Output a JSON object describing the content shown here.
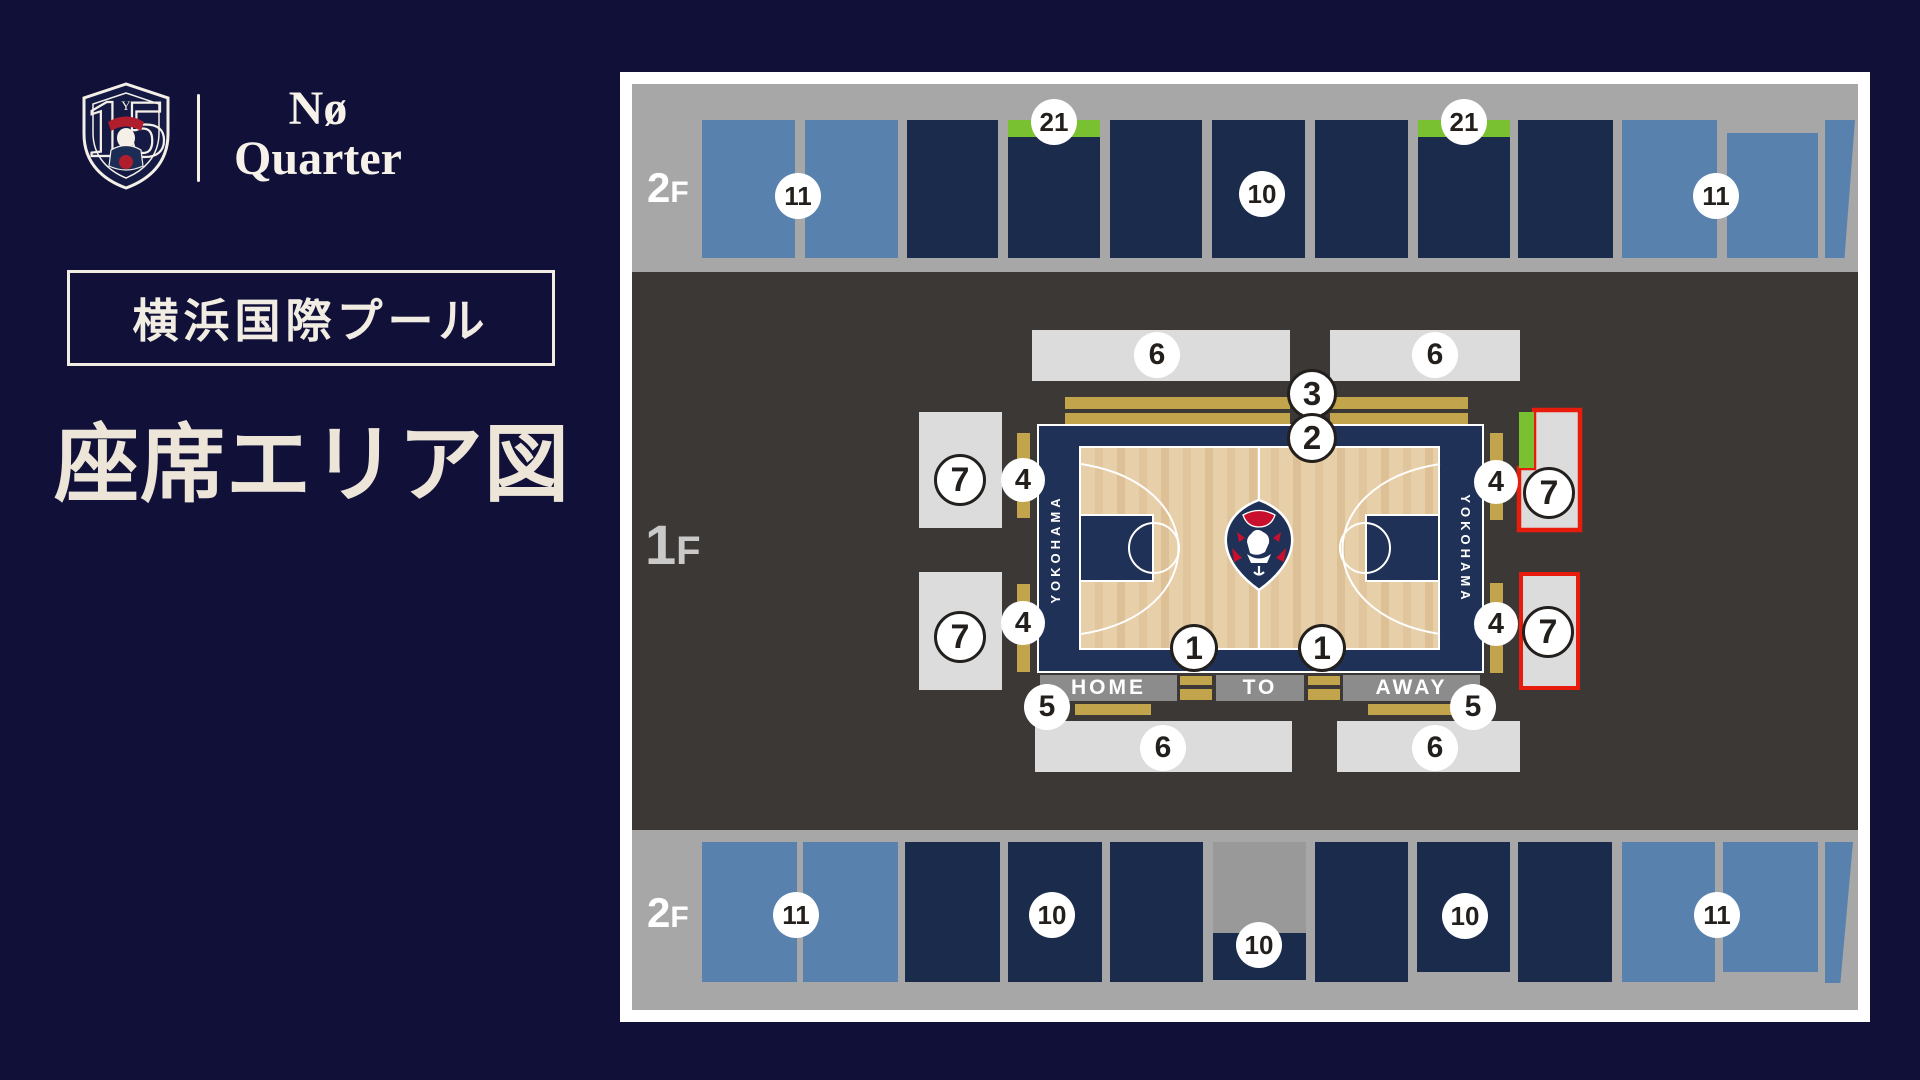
{
  "brand": {
    "anniversary_number": "15",
    "wordmark_top": "Nø",
    "wordmark_bottom": "Quarter",
    "pennant_letter": "Y"
  },
  "venue_label": "横浜国際プール",
  "page_title": "座席エリア図",
  "court": {
    "home_label": "HOME",
    "table_officials_label": "TO",
    "away_label": "AWAY",
    "side_text_left": "YOKOHAMA",
    "side_text_right": "YOKOHAMA"
  },
  "colors": {
    "pageBg": "#101038",
    "cream": "#ece5d8",
    "bandGray": "#a7a7a7",
    "notchGray": "#999999",
    "charcoal": "#3b3835",
    "lightBlue": "#5881ae",
    "navyBlock": "#1a2b4c",
    "lightGray": "#dcdcdc",
    "barGray": "#8c8c8c",
    "gold": "#c2a44c",
    "courtNavy": "#1f3156",
    "wood": "#e7cfa9",
    "red": "#e81c0c",
    "green": "#79c131",
    "badgeText": "#231f1c",
    "white": "#ffffff"
  },
  "map": {
    "floor_labels": [
      {
        "num": "2",
        "suf": "F",
        "x": 27,
        "y": 92,
        "numSize": 42,
        "sufSize": 30,
        "color": "#ffffff"
      },
      {
        "num": "1",
        "suf": "F",
        "x": 25,
        "y": 440,
        "numSize": 56,
        "sufSize": 40,
        "color": "#c9c9c9"
      },
      {
        "num": "2",
        "suf": "F",
        "x": 27,
        "y": 817,
        "numSize": 42,
        "sufSize": 30,
        "color": "#ffffff"
      }
    ],
    "top_blocks": [
      {
        "x": 82,
        "y": 48,
        "w": 93,
        "h": 138,
        "c": "lightBlue"
      },
      {
        "x": 185,
        "y": 48,
        "w": 93,
        "h": 138,
        "c": "lightBlue"
      },
      {
        "x": 287,
        "y": 48,
        "w": 91,
        "h": 138,
        "c": "navyBlock"
      },
      {
        "x": 388,
        "y": 48,
        "w": 92,
        "h": 138,
        "c": "navyBlock",
        "strip": true
      },
      {
        "x": 490,
        "y": 48,
        "w": 92,
        "h": 138,
        "c": "navyBlock"
      },
      {
        "x": 592,
        "y": 48,
        "w": 93,
        "h": 138,
        "c": "navyBlock"
      },
      {
        "x": 695,
        "y": 48,
        "w": 93,
        "h": 138,
        "c": "navyBlock"
      },
      {
        "x": 798,
        "y": 48,
        "w": 92,
        "h": 138,
        "c": "navyBlock",
        "strip": true
      },
      {
        "x": 898,
        "y": 48,
        "w": 95,
        "h": 138,
        "c": "navyBlock"
      },
      {
        "x": 1002,
        "y": 48,
        "w": 95,
        "h": 138,
        "c": "lightBlue"
      },
      {
        "x": 1107,
        "y": 61,
        "w": 91,
        "h": 125,
        "c": "lightBlue"
      },
      {
        "x": 1205,
        "y": 48,
        "w": 30,
        "h": 138,
        "c": "lightBlue",
        "clip": "polygon(0 0,100% 0,65% 100%,0 100%)"
      }
    ],
    "bottom_blocks": [
      {
        "x": 82,
        "y": 770,
        "w": 95,
        "h": 140,
        "c": "lightBlue"
      },
      {
        "x": 183,
        "y": 770,
        "w": 95,
        "h": 140,
        "c": "lightBlue"
      },
      {
        "x": 285,
        "y": 770,
        "w": 95,
        "h": 140,
        "c": "navyBlock"
      },
      {
        "x": 388,
        "y": 770,
        "w": 94,
        "h": 140,
        "c": "navyBlock"
      },
      {
        "x": 490,
        "y": 770,
        "w": 93,
        "h": 140,
        "c": "navyBlock"
      },
      {
        "x": 593,
        "y": 770,
        "w": 93,
        "h": 91,
        "c": "notchGray"
      },
      {
        "x": 593,
        "y": 861,
        "w": 93,
        "h": 47,
        "c": "navyBlock"
      },
      {
        "x": 695,
        "y": 770,
        "w": 93,
        "h": 140,
        "c": "navyBlock"
      },
      {
        "x": 797,
        "y": 770,
        "w": 93,
        "h": 130,
        "c": "navyBlock"
      },
      {
        "x": 898,
        "y": 770,
        "w": 94,
        "h": 140,
        "c": "navyBlock"
      },
      {
        "x": 1002,
        "y": 770,
        "w": 93,
        "h": 140,
        "c": "lightBlue"
      },
      {
        "x": 1103,
        "y": 770,
        "w": 95,
        "h": 130,
        "c": "lightBlue"
      },
      {
        "x": 1205,
        "y": 770,
        "w": 28,
        "h": 141,
        "c": "lightBlue",
        "clip": "polygon(0 0,100% 0,55% 100%,0 100%)"
      }
    ],
    "mid_blocks": [
      {
        "x": 412,
        "y": 258,
        "w": 258,
        "h": 51,
        "c": "lightGray"
      },
      {
        "x": 710,
        "y": 258,
        "w": 190,
        "h": 51,
        "c": "lightGray"
      },
      {
        "x": 415,
        "y": 649,
        "w": 257,
        "h": 51,
        "c": "lightGray"
      },
      {
        "x": 717,
        "y": 649,
        "w": 183,
        "h": 51,
        "c": "lightGray"
      },
      {
        "x": 299,
        "y": 340,
        "w": 83,
        "h": 116,
        "c": "lightGray"
      },
      {
        "x": 299,
        "y": 500,
        "w": 83,
        "h": 118,
        "c": "lightGray"
      },
      {
        "x": 899,
        "y": 340,
        "w": 15,
        "h": 56,
        "c": "green"
      },
      {
        "x": 899,
        "y": 500,
        "w": 61,
        "h": 118,
        "c": "lightGray",
        "red": true
      }
    ],
    "gold_bars": [
      {
        "x": 445,
        "y": 325,
        "w": 225,
        "h": 12
      },
      {
        "x": 445,
        "y": 341,
        "w": 225,
        "h": 11
      },
      {
        "x": 710,
        "y": 325,
        "w": 138,
        "h": 12
      },
      {
        "x": 710,
        "y": 341,
        "w": 138,
        "h": 11
      },
      {
        "x": 397,
        "y": 361,
        "w": 13,
        "h": 85
      },
      {
        "x": 397,
        "y": 512,
        "w": 13,
        "h": 88
      },
      {
        "x": 870,
        "y": 361,
        "w": 13,
        "h": 87
      },
      {
        "x": 870,
        "y": 511,
        "w": 13,
        "h": 90
      },
      {
        "x": 560,
        "y": 604,
        "w": 32,
        "h": 9
      },
      {
        "x": 560,
        "y": 617,
        "w": 32,
        "h": 11
      },
      {
        "x": 688,
        "y": 604,
        "w": 32,
        "h": 9
      },
      {
        "x": 688,
        "y": 617,
        "w": 32,
        "h": 11
      },
      {
        "x": 455,
        "y": 632,
        "w": 76,
        "h": 11
      },
      {
        "x": 748,
        "y": 632,
        "w": 84,
        "h": 11
      }
    ],
    "team_bars": [
      {
        "label": "HOME",
        "x": 420,
        "y": 603,
        "w": 137,
        "h": 26
      },
      {
        "label": "TO",
        "x": 596,
        "y": 603,
        "w": 88,
        "h": 26
      },
      {
        "label": "AWAY",
        "x": 723,
        "y": 603,
        "w": 137,
        "h": 26
      }
    ],
    "badges": [
      {
        "label": "11",
        "x": 178,
        "y": 124,
        "d": 46
      },
      {
        "label": "21",
        "x": 434,
        "y": 50,
        "d": 46
      },
      {
        "label": "10",
        "x": 642,
        "y": 122,
        "d": 46
      },
      {
        "label": "21",
        "x": 844,
        "y": 50,
        "d": 46
      },
      {
        "label": "11",
        "x": 1096,
        "y": 124,
        "d": 46
      },
      {
        "label": "6",
        "x": 537,
        "y": 283,
        "d": 46
      },
      {
        "label": "6",
        "x": 815,
        "y": 283,
        "d": 46
      },
      {
        "label": "3",
        "x": 692,
        "y": 322,
        "d": 50,
        "ring": true
      },
      {
        "label": "2",
        "x": 692,
        "y": 366,
        "d": 50,
        "ring": true
      },
      {
        "label": "7",
        "x": 340,
        "y": 408,
        "d": 52,
        "ring": true
      },
      {
        "label": "4",
        "x": 403,
        "y": 408,
        "d": 44
      },
      {
        "label": "7",
        "x": 340,
        "y": 565,
        "d": 52,
        "ring": true
      },
      {
        "label": "4",
        "x": 403,
        "y": 551,
        "d": 44
      },
      {
        "label": "4",
        "x": 876,
        "y": 410,
        "d": 44
      },
      {
        "label": "7",
        "x": 929,
        "y": 421,
        "d": 52,
        "ring": true
      },
      {
        "label": "4",
        "x": 876,
        "y": 552,
        "d": 44
      },
      {
        "label": "7",
        "x": 928,
        "y": 560,
        "d": 52,
        "ring": true
      },
      {
        "label": "1",
        "x": 574,
        "y": 576,
        "d": 48,
        "ring": true
      },
      {
        "label": "1",
        "x": 702,
        "y": 576,
        "d": 48,
        "ring": true
      },
      {
        "label": "5",
        "x": 427,
        "y": 635,
        "d": 46
      },
      {
        "label": "5",
        "x": 853,
        "y": 635,
        "d": 46
      },
      {
        "label": "6",
        "x": 543,
        "y": 676,
        "d": 46
      },
      {
        "label": "6",
        "x": 815,
        "y": 676,
        "d": 46
      },
      {
        "label": "11",
        "x": 176,
        "y": 843,
        "d": 46
      },
      {
        "label": "10",
        "x": 432,
        "y": 843,
        "d": 46
      },
      {
        "label": "10",
        "x": 639,
        "y": 873,
        "d": 46
      },
      {
        "label": "10",
        "x": 845,
        "y": 844,
        "d": 46
      },
      {
        "label": "11",
        "x": 1097,
        "y": 843,
        "d": 46
      }
    ]
  }
}
